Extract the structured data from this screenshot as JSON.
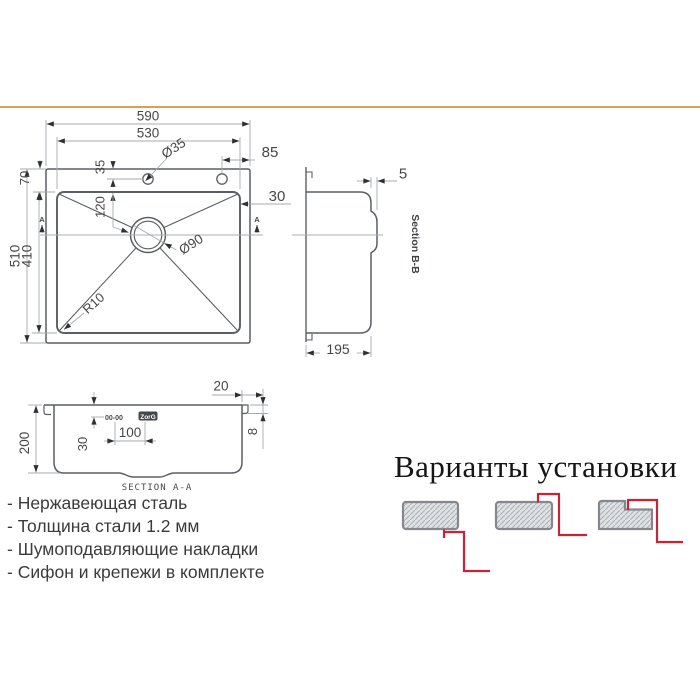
{
  "accent": {
    "rule_color": "#d9a24e",
    "red": "#c5253b"
  },
  "drawing": {
    "top_view": {
      "width_total": "590",
      "width_bowl": "530",
      "hole_offset_right": "85",
      "hole_diameter": "Ø35",
      "hole_from_edge": "35",
      "rim_left": "70",
      "drain_offset": "120",
      "height_total": "510",
      "height_bowl": "410",
      "drain_diameter": "Ø90",
      "rim_right": "30",
      "corner_radius": "R10",
      "section_marker_left": "A",
      "section_marker_right": "A"
    },
    "section_b": {
      "label": "Section B-B",
      "rim_lip": "5",
      "depth": "195"
    },
    "section_a": {
      "label": "SECTION A-A",
      "depth": "200",
      "overflow_offset": "30",
      "logo_offset": "100",
      "edge_offset": "20",
      "rim_height": "8",
      "overflow_marks": "00-00",
      "brand": "ZorG"
    }
  },
  "install": {
    "title": "Варианты установки"
  },
  "features": [
    "- Нержавеющая сталь",
    "- Толщина стали 1.2 мм",
    "- Шумоподавляющие накладки",
    "- Сифон и крепежи в комплекте"
  ]
}
